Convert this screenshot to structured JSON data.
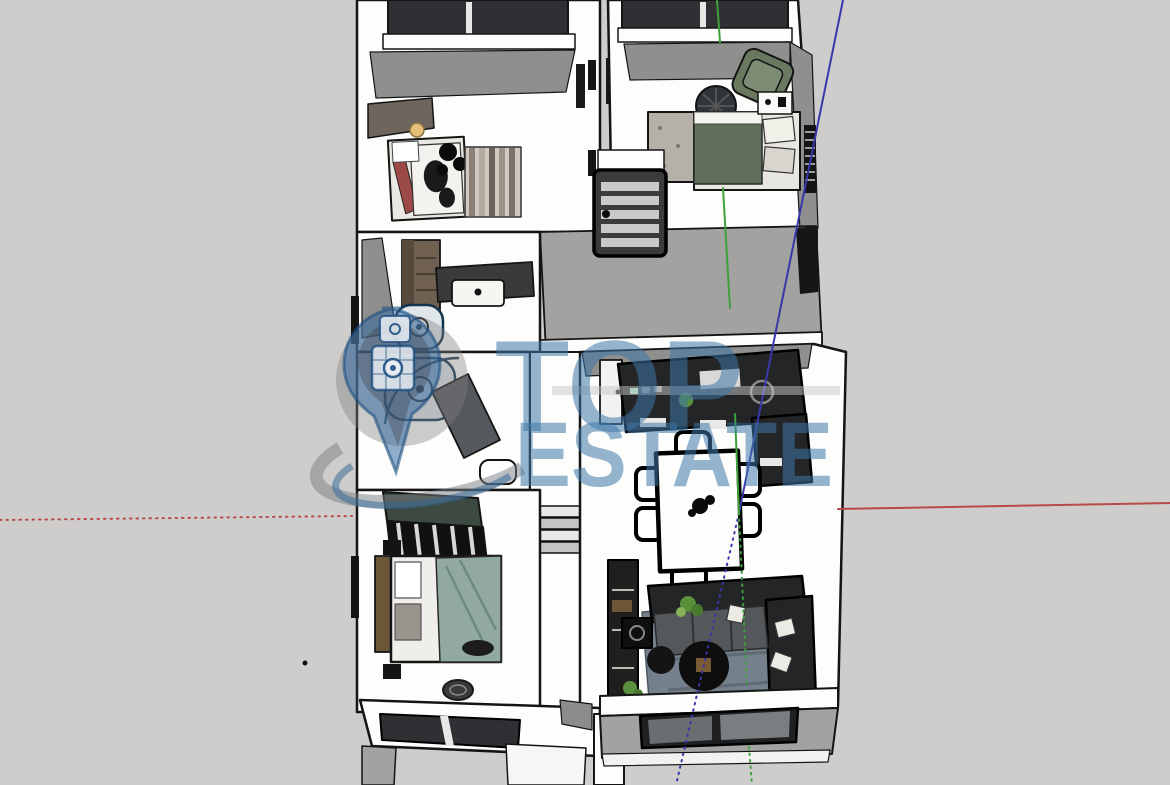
{
  "scene": {
    "description": "3D cutaway top-down render of an apartment floor plan (SketchUp style) with drawing axes and a watermark",
    "watermark": {
      "line1": "TOP",
      "line2": "ESTATE"
    },
    "rooms": [
      "top-left-bedroom",
      "top-right-bedroom",
      "stair-hallway",
      "bathroom-vanity-room",
      "shower-room",
      "corridor",
      "kitchen-dining-living-room",
      "bottom-left-bedroom",
      "lower-level-roofs"
    ],
    "stray_mark": {
      "x": 305,
      "y": 663
    }
  },
  "colors": {
    "background": "#cecdcb",
    "outline": "#141414",
    "wall_white": "#fdfdfb",
    "wall_gray": "#8f8f8d",
    "floor_gray": "#a2a2a0",
    "window_dark": "#2e3033",
    "furniture_dark": "#232527",
    "sofa_seat": "#54585a",
    "rug_blue_gray": "#74808c",
    "wood_brown": "#6f6051",
    "armchair_green": "#69785f",
    "bed_green": "#5f6f5a",
    "bed_teal": "#92a9a1",
    "plant_green": "#5a8f3c",
    "accent_red": "#9c4a48",
    "lamp_yellow": "#e4c07a",
    "watermark_blue": "rgba(62,118,168,0.55)",
    "watermark_gray": "rgba(120,126,132,0.5)",
    "axis_red": "#b84b48",
    "axis_green": "#3da03d",
    "axis_blue": "#3838aa"
  },
  "axes": {
    "origin": [
      739,
      513
    ],
    "red_solid": [
      [
        838,
        509
      ],
      [
        1170,
        503
      ]
    ],
    "red_dotted": [
      [
        0,
        520
      ],
      [
        352,
        516
      ]
    ],
    "blue_solid": [
      [
        843,
        0
      ],
      [
        739,
        513
      ]
    ],
    "blue_dotted": [
      [
        739,
        513
      ],
      [
        676,
        785
      ]
    ],
    "green_solid_segments": [
      [
        [
          717,
          0
        ],
        [
          720,
          42
        ]
      ],
      [
        [
          723,
          188
        ],
        [
          730,
          308
        ]
      ],
      [
        [
          735,
          414
        ],
        [
          739,
          513
        ]
      ]
    ],
    "green_dotted_segments": [
      [
        [
          739,
          513
        ],
        [
          747,
          688
        ]
      ],
      [
        [
          749,
          747
        ],
        [
          752,
          785
        ]
      ]
    ]
  }
}
